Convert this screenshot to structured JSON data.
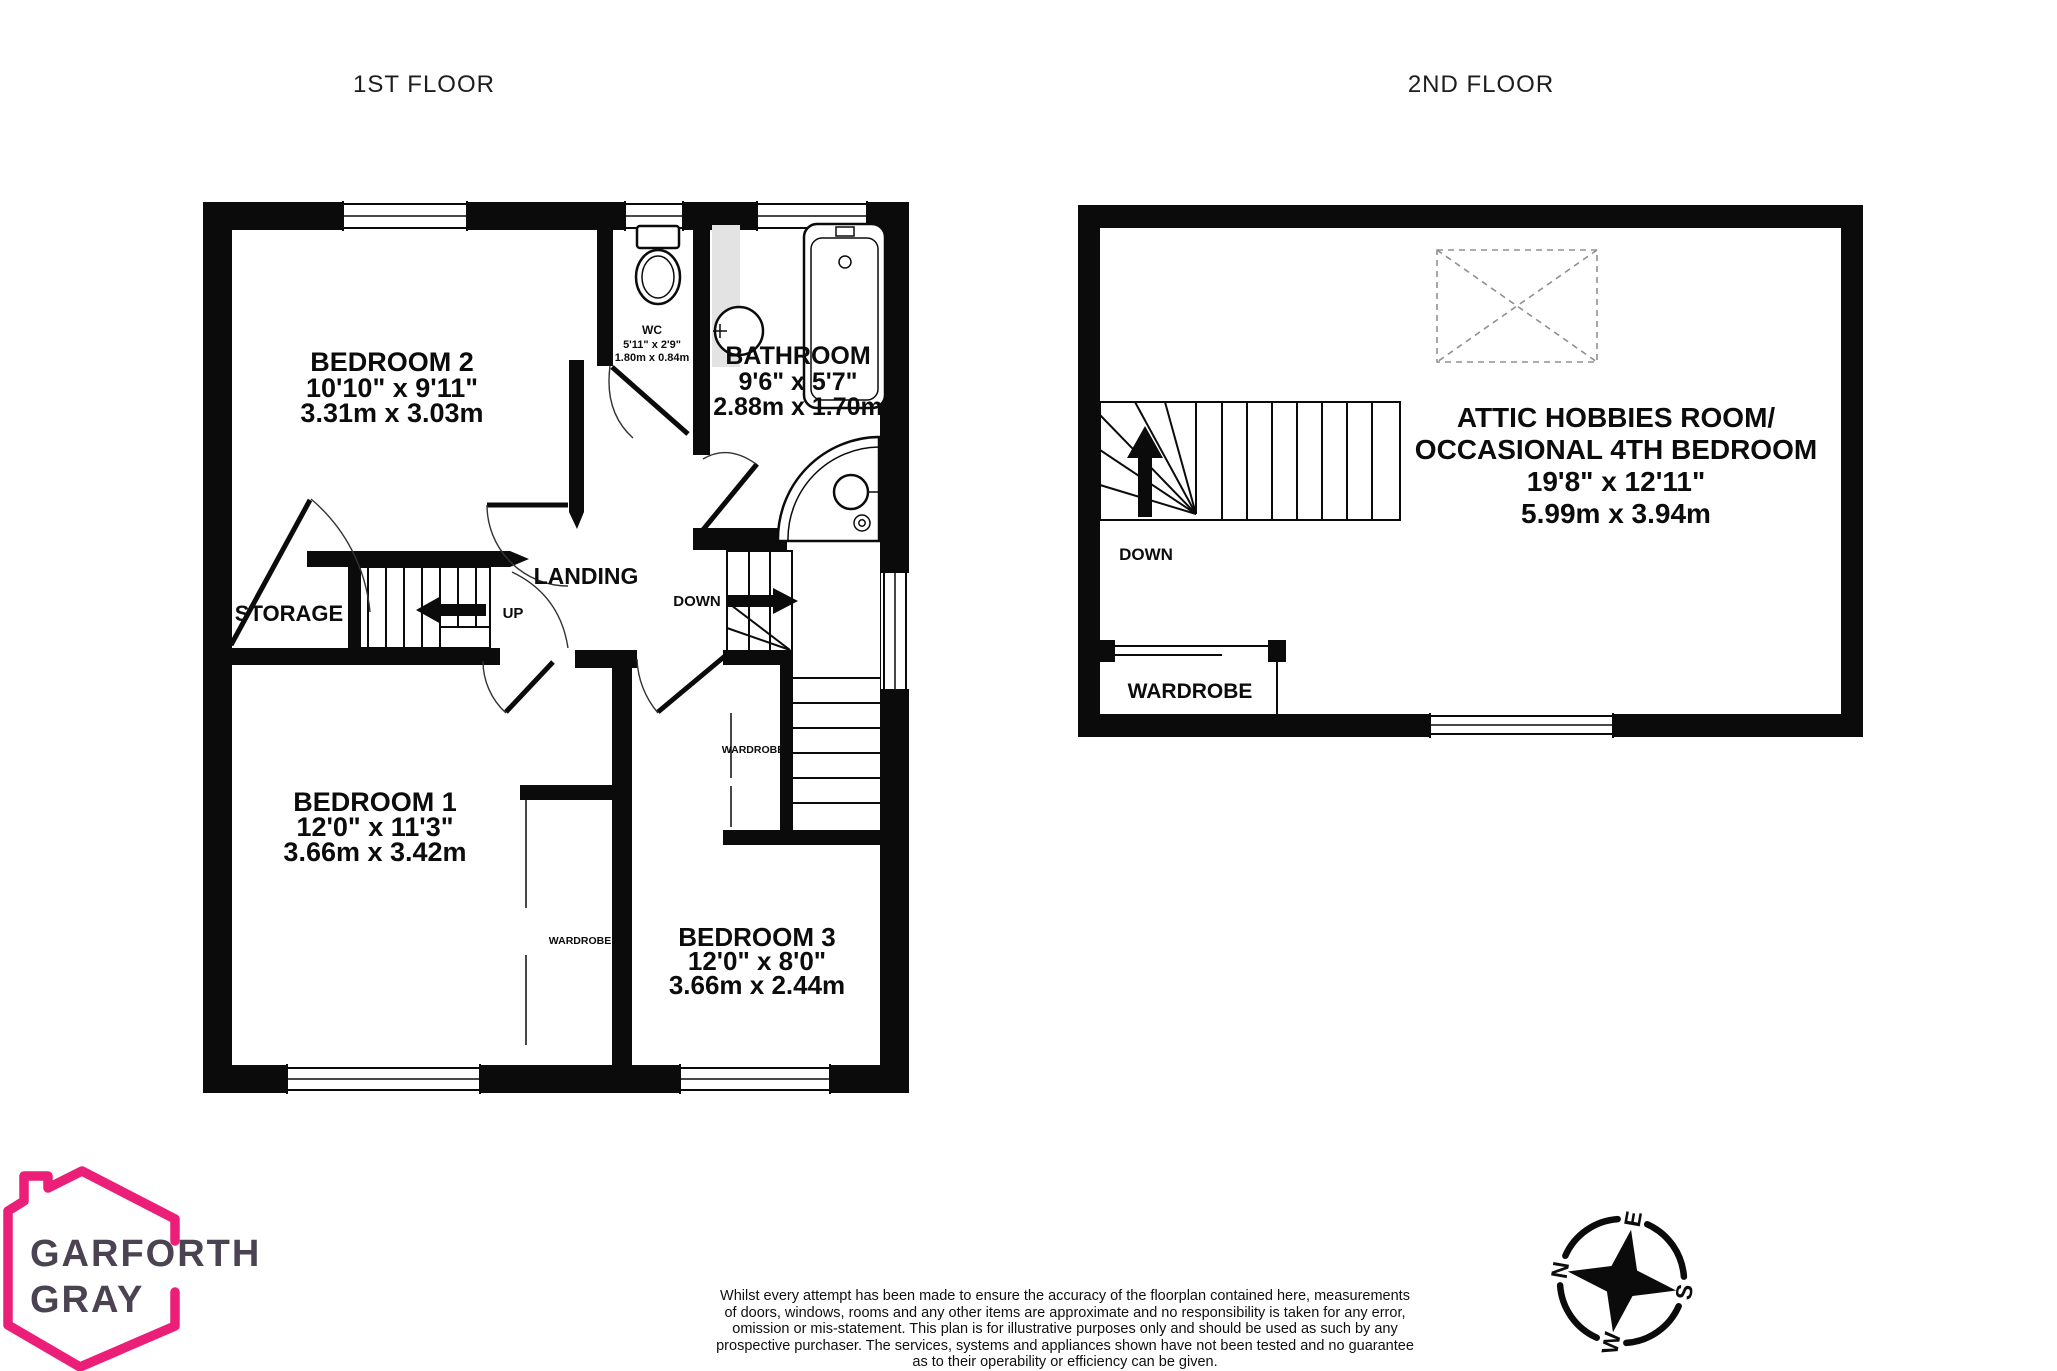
{
  "titles": {
    "floor1": "1ST FLOOR",
    "floor2": "2ND FLOOR"
  },
  "floor1": {
    "bedroom2": {
      "name": "BEDROOM 2",
      "imperial": "10'10\"  x 9'11\"",
      "metric": "3.31m  x 3.03m"
    },
    "wc": {
      "name": "WC",
      "imperial": "5'11\"  x 2'9\"",
      "metric": "1.80m  x 0.84m"
    },
    "bathroom": {
      "name": "BATHROOM",
      "imperial": "9'6\"  x 5'7\"",
      "metric": "2.88m  x 1.70m"
    },
    "bedroom1": {
      "name": "BEDROOM 1",
      "imperial": "12'0\"  x 11'3\"",
      "metric": "3.66m  x 3.42m"
    },
    "bedroom3": {
      "name": "BEDROOM 3",
      "imperial": "12'0\"  x 8'0\"",
      "metric": "3.66m  x 2.44m"
    },
    "landing": "LANDING",
    "storage": "STORAGE",
    "up": "UP",
    "down": "DOWN",
    "wardrobe_bed1": "WARDROBE",
    "wardrobe_bed3": "WARDROBE"
  },
  "floor2": {
    "attic": {
      "name_line1": "ATTIC HOBBIES ROOM/",
      "name_line2": "OCCASIONAL 4TH BEDROOM",
      "imperial": "19'8\"  x 12'11\"",
      "metric": "5.99m  x 3.94m"
    },
    "down": "DOWN",
    "wardrobe": "WARDROBE"
  },
  "logo": {
    "line1": "GARFORTH",
    "line2": "GRAY"
  },
  "compass": {
    "n": "N",
    "e": "E",
    "s": "S",
    "w": "W"
  },
  "colors": {
    "wall": "#0b0b0b",
    "logo_pink": "#EC1F78",
    "logo_text": "#4B4351"
  },
  "disclaimer": {
    "lines": [
      "Whilst every attempt has been made to ensure the accuracy of the floorplan contained here, measurements",
      "of doors, windows, rooms and any other items are approximate and no responsibility is taken for any error,",
      "omission or mis-statement. This plan is for illustrative purposes only and should be used as such by any",
      "prospective purchaser. The services, systems and appliances shown have not been tested and no guarantee",
      "as to their operability or efficiency can be given."
    ]
  }
}
